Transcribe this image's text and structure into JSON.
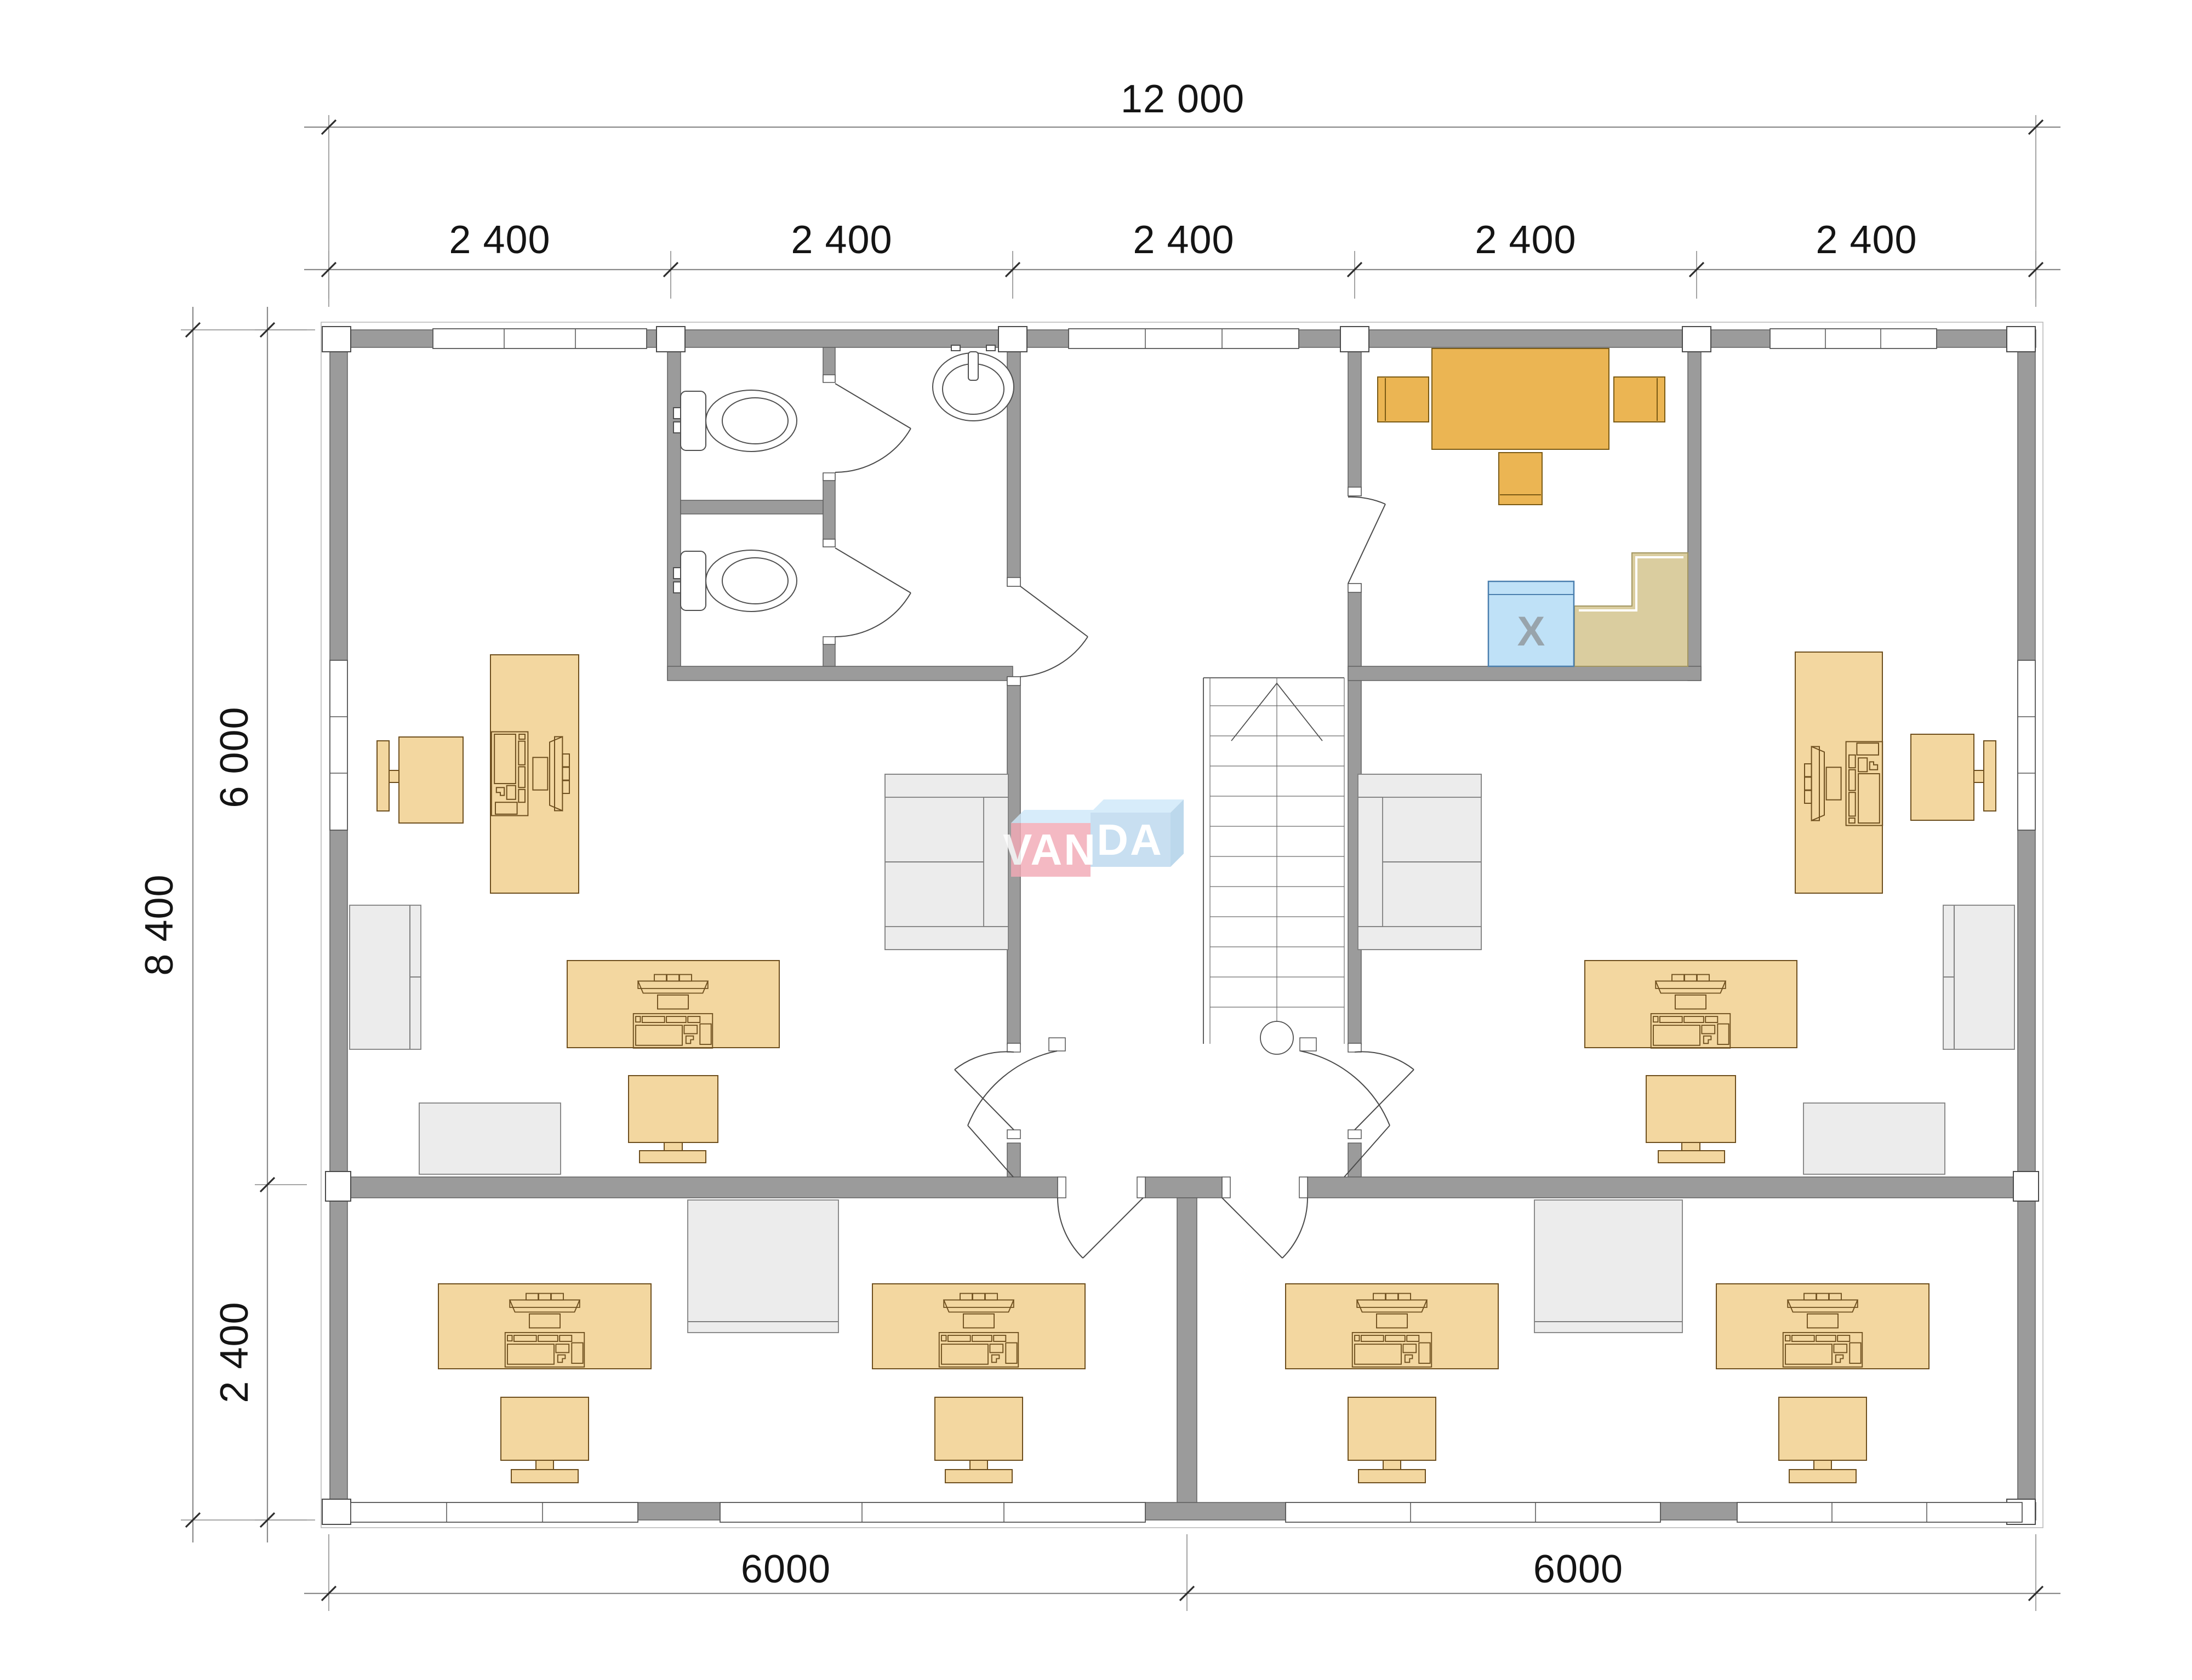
{
  "watermark": {
    "van": "VAN",
    "da": "DA"
  },
  "kitchen": {
    "appliance_label": "X"
  },
  "dims": {
    "top_total": "12 000",
    "top_segments": [
      "2 400",
      "2 400",
      "2 400",
      "2 400",
      "2 400"
    ],
    "left_total": "8 400",
    "left_upper": "6 000",
    "left_lower": "2 400",
    "bottom_left": "6000",
    "bottom_right": "6000"
  },
  "colors": {
    "wall_grey": "#9b9b9b",
    "furniture_tan": "#F3D7A0",
    "table_amber": "#EBB553",
    "furniture_grey": "#ECECEC",
    "counter_tan": "#DACD9F",
    "appliance_blue": "#BFE1F7",
    "logo_pink": "#F2AAB6",
    "logo_blue": "#BCD9EE",
    "logo_topface": "#CFE9FA",
    "dimension_text": "#141414"
  }
}
